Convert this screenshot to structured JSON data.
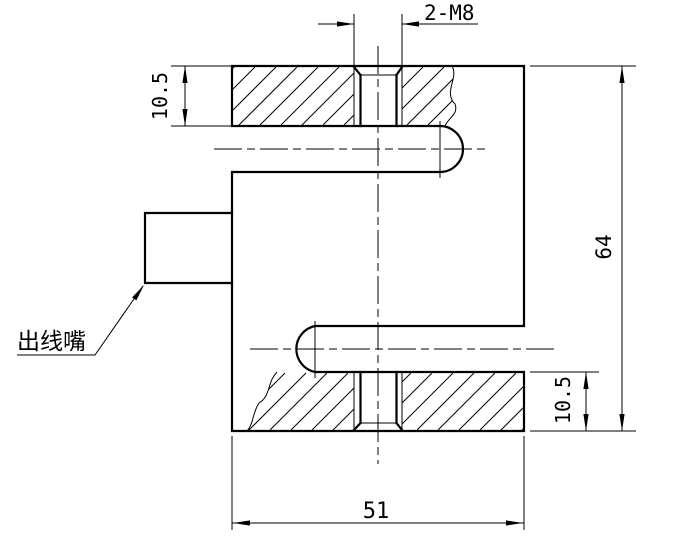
{
  "drawing": {
    "title": "S-type load cell section drawing",
    "labels": {
      "thread_callout": "2-M8",
      "top_plate_thickness": "10.5",
      "total_height": "64",
      "bottom_plate_thickness": "10.5",
      "overall_width": "51",
      "cable_outlet": "出线嘴"
    },
    "colors": {
      "line": "#000000",
      "background": "#ffffff"
    }
  }
}
